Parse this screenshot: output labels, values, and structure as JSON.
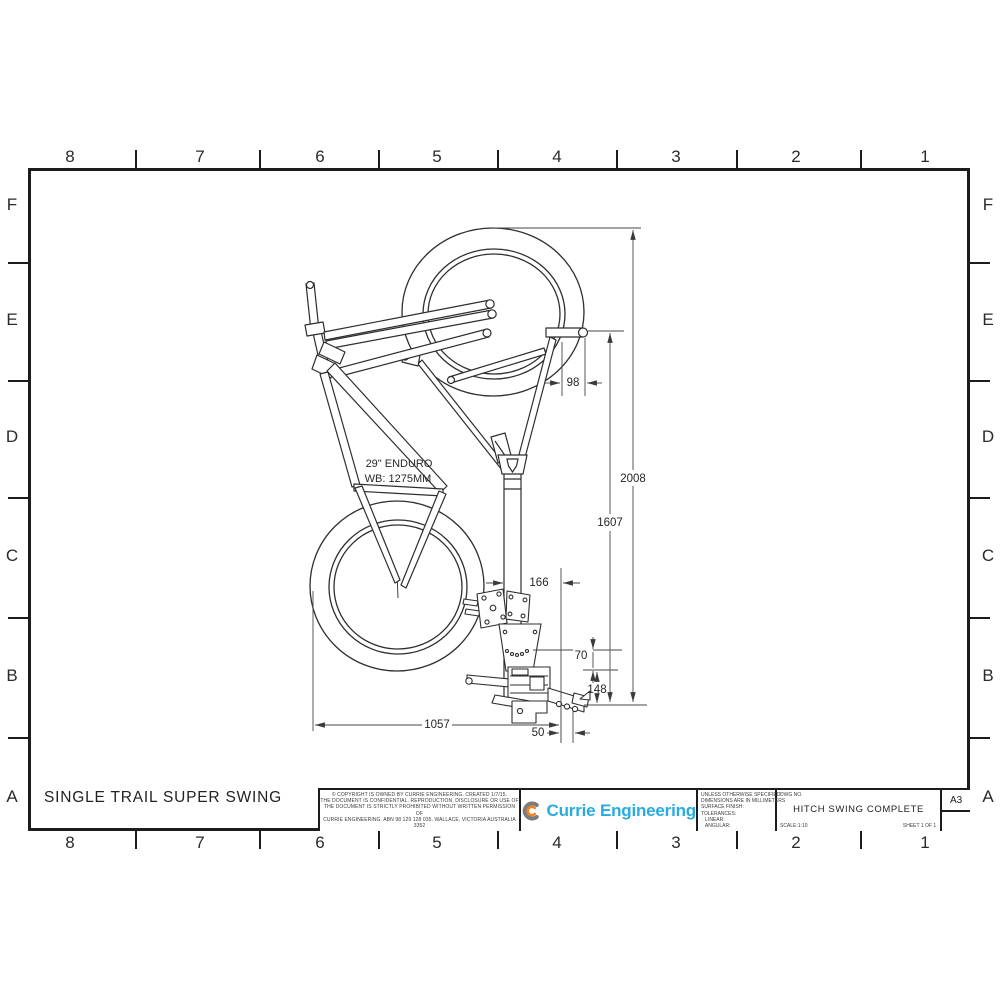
{
  "sheet": {
    "border": {
      "columns": [
        "8",
        "7",
        "6",
        "5",
        "4",
        "3",
        "2",
        "1"
      ],
      "rows": [
        "F",
        "E",
        "D",
        "C",
        "B",
        "A"
      ]
    },
    "footer_title": "SINGLE TRAIL SUPER SWING"
  },
  "drawing": {
    "bike_label_line1": "29\" ENDURO",
    "bike_label_line2": "WB: 1275MM",
    "dims": {
      "overall_height": "2008",
      "handlebar_height": "1607",
      "handlebar_offset": "98",
      "post_to_hitch": "166",
      "plate_drop": "70",
      "hitch_drop": "148",
      "bike_reach": "1057",
      "pin_offset": "50"
    }
  },
  "title_block": {
    "copyright_lines": [
      "© COPYRIGHT IS OWNED BY CURRIE ENGINEERING. CREATED 1/7/15.",
      "THE DOCUMENT IS CONFIDENTIAL. REPRODUCTION, DISCLOSURE OR USE OF",
      "THE DOCUMENT IS STRICTLY PROHIBITED WITHOUT WRITTEN PERMISSION OF",
      "CURRIE ENGINEERING. ABN 98 129 128 035. WALLACE, VICTORIA AUSTRALIA 3352"
    ],
    "logo_text": "Currie Engineering",
    "notes_lines": [
      "UNLESS OTHERWISE SPECIFIED:",
      "DIMENSIONS ARE IN MILLIMETERS",
      "SURFACE FINISH:",
      "TOLERANCES:",
      "   LINEAR:",
      "   ANGULAR:"
    ],
    "dwg_no_label": "DWG NO.",
    "drawing_title": "HITCH SWING COMPLETE",
    "scale_label": "SCALE:1:10",
    "sheet_label": "SHEET 1 OF 1",
    "paper_size": "A3"
  },
  "colors": {
    "logo_blue": "#29ABE2",
    "logo_orange": "#F58220",
    "logo_grey": "#7B7C7F",
    "line": "#2E2E30"
  }
}
